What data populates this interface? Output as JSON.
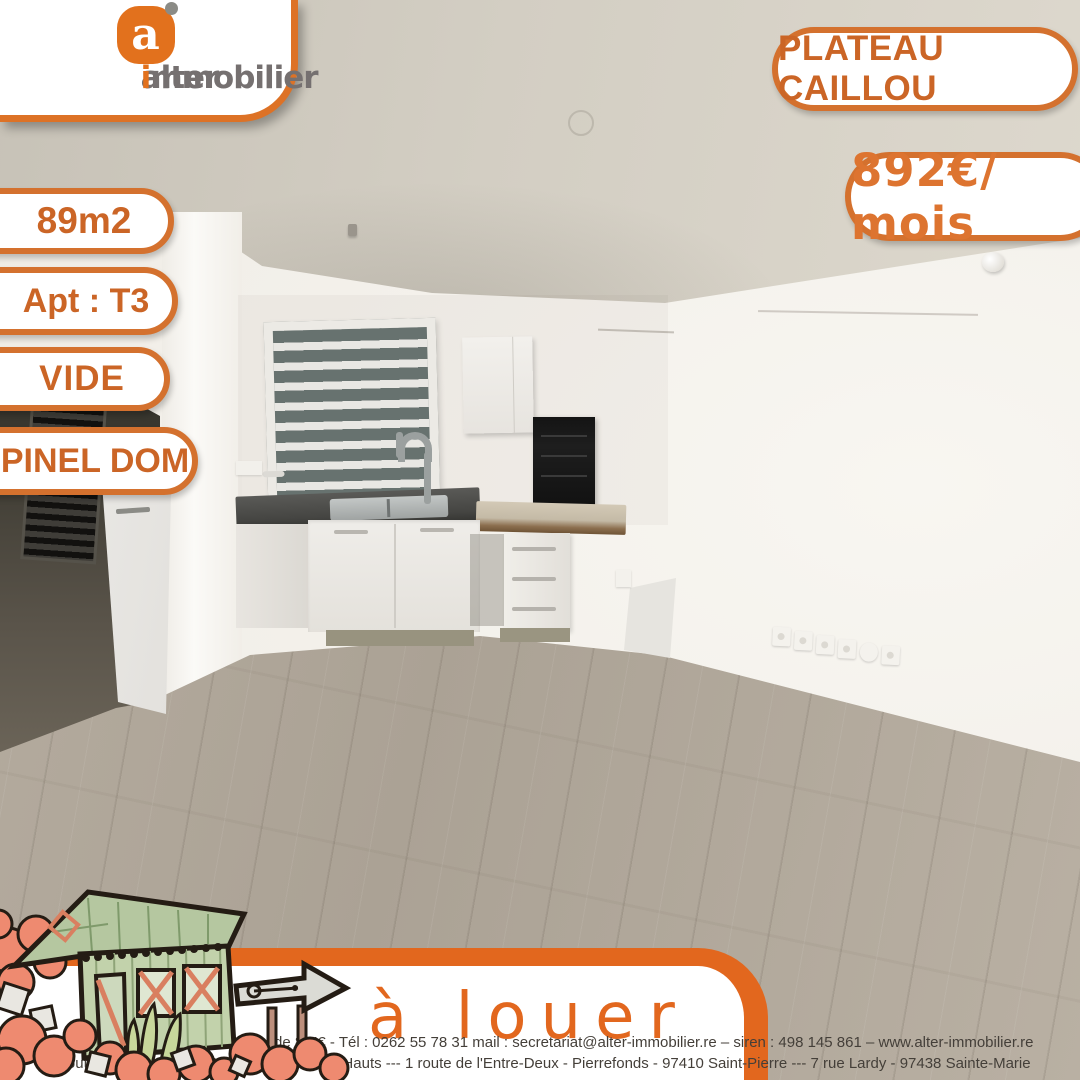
{
  "brand": {
    "icon_letter": "a",
    "word_prefix": "alter",
    "word_accent": "i",
    "word_suffix": "mmobilier"
  },
  "badges": {
    "location": "PLATEAU CAILLOU",
    "price": "892€/ mois",
    "area": "89m2",
    "type": "Apt : T3",
    "furnishing": "VIDE",
    "scheme": "PINEL DOM"
  },
  "banner": {
    "status": "à louer"
  },
  "footer": {
    "line1_bold": "Alter Immobilier",
    "line1_rest": " – sarl au capital de 8 K€ - Tél : 0262 55 78 31 mail : secretariat@alter-immobilier.re – siren : 498 145 861 – www.alter-immobilier.re",
    "line2": "6 route de l'Eperon – 97435 Saint-Gilles les Hauts --- 1 route de l'Entre-Deux - Pierrefonds - 97410 Saint-Pierre --- 7 rue Lardy - 97438 Sainte-Marie"
  },
  "colors": {
    "brand_orange": "#e2711d",
    "pill_border_orange": "#d4712e",
    "pill_text_orange": "#cb6526",
    "banner_orange": "#e2671e",
    "logo_gray": "#757070",
    "footer_text": "#443f39",
    "floor_wood": "#aba295",
    "ceiling_gray": "#d3cec3",
    "wall_white": "#f2efe9"
  },
  "photo": {
    "description": "empty T3 apartment, open-plan kitchen with louvered window, wood laminate floor, open white door to dark room"
  }
}
